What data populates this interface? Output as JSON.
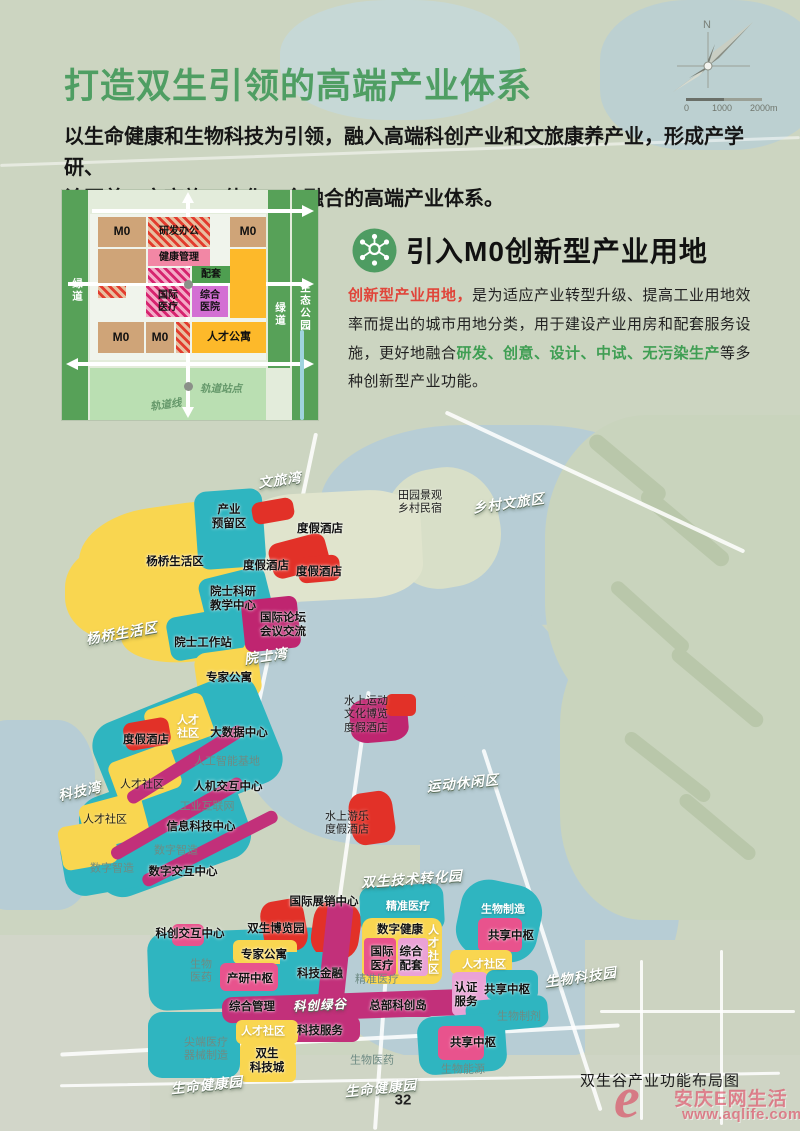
{
  "header": {
    "title": "打造双生引领的高端产业体系",
    "subtitle": "以生命健康和生物科技为引领，融入高端科创产业和文旅康养产业，形成产学研、\n诊医养、文商旅一体化、全融合的高端产业体系。",
    "title_color": "#4f9e63"
  },
  "compass": {
    "north": "N",
    "scale_labels": [
      "0",
      "1000",
      "2000m"
    ]
  },
  "diagram": {
    "left_strip": "绿道",
    "right_inner_strip": "绿道",
    "right_outer_strip": "生态公园",
    "rail_station": "轨道站点",
    "rail_line": "轨道线",
    "cells": {
      "m0_a": "M0",
      "m0_b": "M0",
      "m0_c": "M0",
      "m0_d": "M0",
      "rd_office": "研发办公",
      "health_mgmt": "健康管理",
      "support": "配套",
      "intl_medical": "国际\n医疗",
      "general_hospital": "综合\n医院",
      "talent_apartment": "人才公寓"
    }
  },
  "m0_section": {
    "heading": "引入M0创新型产业用地",
    "icon": "molecule-icon",
    "body": [
      {
        "text": "创新型产业用地，",
        "color": "#e0453a"
      },
      {
        "text": "是为适应产业转型升级、提高工业用地效率而提出的城市用地分类，用于建设产业用房和配套服务设施，更好地融合",
        "color": "#222222"
      },
      {
        "text": "研发、创意、设计、中试、无污染生产",
        "color": "#3f9e53"
      },
      {
        "text": "等多种创新型产业功能。",
        "color": "#222222"
      }
    ]
  },
  "map": {
    "caption": "双生谷产业功能布局图",
    "watermark": {
      "logo": "e",
      "name": "安庆E网生活",
      "url": "www.aqlife.com"
    },
    "labels": [
      {
        "text": "文旅湾"
      },
      {
        "text": "乡村文旅区"
      },
      {
        "text": "杨桥生活区"
      },
      {
        "text": "院士湾"
      },
      {
        "text": "科技湾"
      },
      {
        "text": "运动休闲区"
      },
      {
        "text": "双生技术转化园"
      },
      {
        "text": "生命健康园"
      },
      {
        "text": "生命健康园"
      },
      {
        "text": "生物科技园"
      },
      {
        "text": "科创绿谷"
      },
      {
        "text": "度假酒店"
      },
      {
        "text": "度假酒店"
      },
      {
        "text": "度假酒店"
      },
      {
        "text": "田园景观\n乡村民宿"
      },
      {
        "text": "产业\n预留区"
      },
      {
        "text": "杨桥生活区"
      },
      {
        "text": "院士科研\n教学中心"
      },
      {
        "text": "国际论坛\n会议交流"
      },
      {
        "text": "院士工作站"
      },
      {
        "text": "专家公寓"
      },
      {
        "text": "水上运动\n文化博览\n度假酒店"
      },
      {
        "text": "度假酒店"
      },
      {
        "text": "人才\n社区"
      },
      {
        "text": "大数据中心"
      },
      {
        "text": "人工智能基地"
      },
      {
        "text": "人才社区"
      },
      {
        "text": "人机交互中心"
      },
      {
        "text": "工业互联网"
      },
      {
        "text": "信息科技中心"
      },
      {
        "text": "人才社区"
      },
      {
        "text": "数字智造"
      },
      {
        "text": "数字智造"
      },
      {
        "text": "数字交互中心"
      },
      {
        "text": "水上游乐\n度假酒店"
      },
      {
        "text": "国际展销中心"
      },
      {
        "text": "科创交互中心"
      },
      {
        "text": "双生博览园"
      },
      {
        "text": "专家公寓"
      },
      {
        "text": "生物\n医药"
      },
      {
        "text": "产研中枢"
      },
      {
        "text": "科技金融"
      },
      {
        "text": "精准医疗"
      },
      {
        "text": "数字健康"
      },
      {
        "text": "国际\n医疗"
      },
      {
        "text": "综合\n配套"
      },
      {
        "text": "人才社区"
      },
      {
        "text": "精准医疗"
      },
      {
        "text": "综合管理"
      },
      {
        "text": "总部科创岛"
      },
      {
        "text": "科技服务"
      },
      {
        "text": "人才社区"
      },
      {
        "text": "尖端医疗\n器械制造"
      },
      {
        "text": "双生\n科技城"
      },
      {
        "text": "生物医药"
      },
      {
        "text": "生物制造"
      },
      {
        "text": "共享中枢"
      },
      {
        "text": "人才社区"
      },
      {
        "text": "认证\n服务"
      },
      {
        "text": "共享中枢"
      },
      {
        "text": "生物制剂"
      },
      {
        "text": "共享中枢"
      },
      {
        "text": "生物能源"
      }
    ]
  },
  "footer": {
    "page_number": "32"
  },
  "colors": {
    "accent_green": "#4f9e63",
    "teal": "#2fb5c0",
    "yellow": "#f9d650",
    "red": "#e23128",
    "magenta": "#c2307a",
    "pink": "#e8538d",
    "light_pink": "#eaa2d6",
    "orchid": "#d36fd3",
    "tan": "#cfa478",
    "water": "#b7cdd5",
    "land": "#ccd5c1",
    "watermark_red": "#db3e58"
  }
}
